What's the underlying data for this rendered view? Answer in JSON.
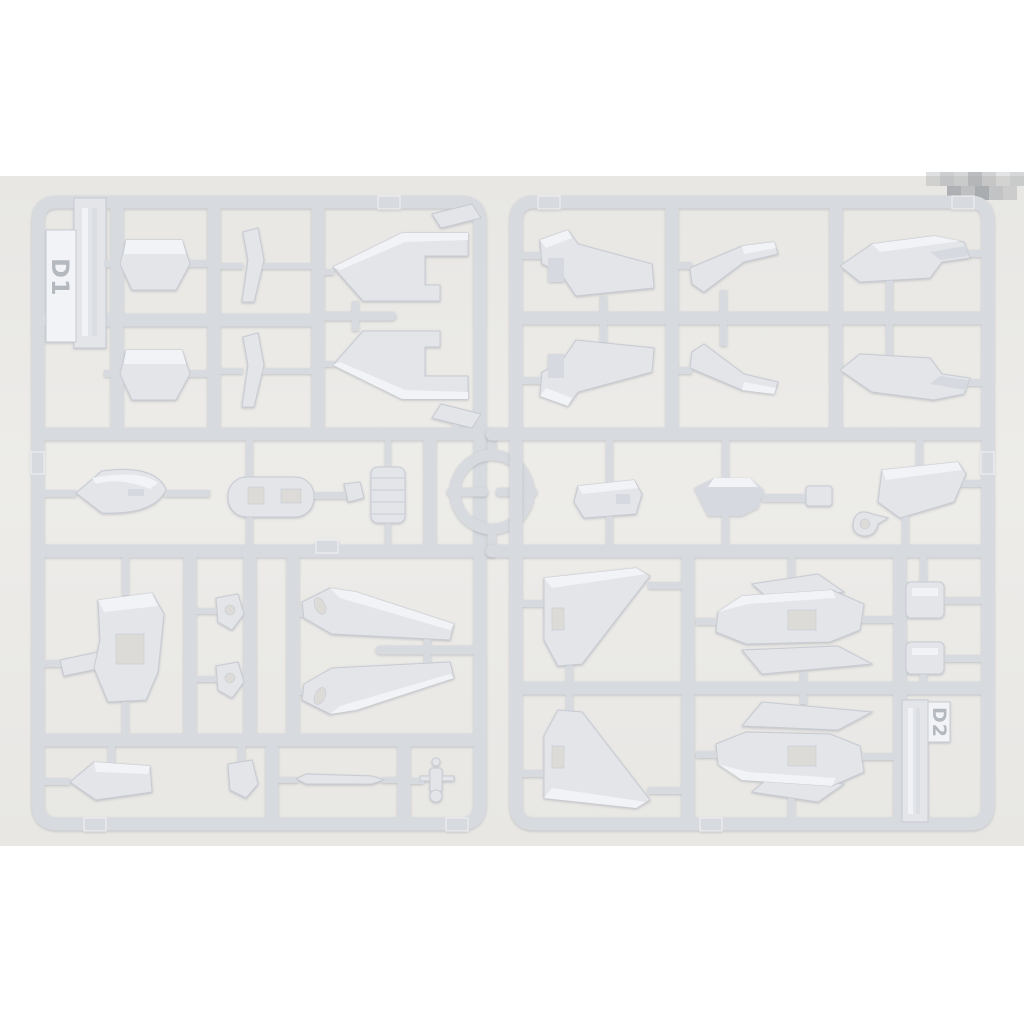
{
  "photo": {
    "runner_labels": {
      "left": "D1",
      "right": "D2"
    },
    "colors": {
      "photo_bg": "#e8e7e4",
      "photo_bg_mid": "#edece9",
      "sprue": "#d7dade",
      "sprue_hi": "#eef0f3",
      "part_fill": "#e3e5e9",
      "part_hi": "#f2f3f6",
      "part_mid": "#d6dae0",
      "part_shade": "#c7cbd2",
      "cutout": "#dcdbd8",
      "tag_text": "#b4b8bf",
      "mosaic": "#a3a6aa"
    }
  }
}
